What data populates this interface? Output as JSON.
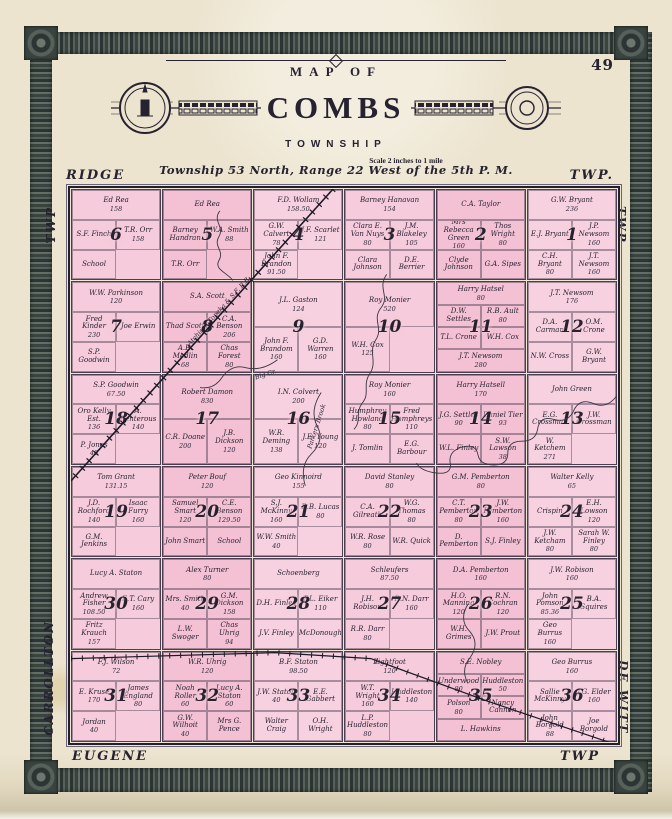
{
  "page": {
    "number": "49"
  },
  "title": {
    "map_of": "MAP OF",
    "name": "COMBS",
    "subtitle": "TOWNSHIP",
    "scale": "Scale 2 inches to 1 mile",
    "legal": "Township 53 North, Range 22 West of the 5th P. M."
  },
  "edges": {
    "top_left": "RIDGE",
    "top_right": "TWP.",
    "left_upper": "TWP",
    "left_lower": "CARROLLTON",
    "right_upper": "TWP",
    "right_lower": "DE WITT",
    "bottom_left": "EUGENE",
    "bottom_right": "TWP"
  },
  "features": {
    "railroad_1": "Atchison Topeka & S.F. R.R.",
    "creek_big": "Big Cr.",
    "creek_parkers": "Parkers Brook"
  },
  "colors": {
    "paper": "#ece4cf",
    "parcel_pink": "#f5c8d8",
    "ink": "#262230",
    "border_band": "#46514c"
  },
  "map": {
    "rows": [
      [
        {
          "number": 6,
          "parcels": [
            {
              "name": "Ed Rea",
              "acres": "158"
            },
            {
              "name": "S.F. Finch"
            },
            {
              "name": "T.R. Orr",
              "acres": "158"
            },
            {
              "name": "School"
            }
          ]
        },
        {
          "number": 5,
          "parcels": [
            {
              "name": "Ed Rea"
            },
            {
              "name": "Barney Handran"
            },
            {
              "name": "W.A. Smith",
              "acres": "88"
            },
            {
              "name": "T.R. Orr"
            }
          ]
        },
        {
          "number": 4,
          "parcels": [
            {
              "name": "F.D. Wollam",
              "acres": "158.50"
            },
            {
              "name": "G.W. Calvert",
              "acres": "78"
            },
            {
              "name": "J.F. Scarlet",
              "acres": "121"
            },
            {
              "name": "John F. Brandon",
              "acres": "91.50"
            }
          ]
        },
        {
          "number": 3,
          "parcels": [
            {
              "name": "Barney Hanavan",
              "acres": "154"
            },
            {
              "name": "Clara E. Van Nuys",
              "acres": "80"
            },
            {
              "name": "J.M. Blakeley",
              "acres": "105"
            },
            {
              "name": "Clara Johnson"
            },
            {
              "name": "D.E. Berrier"
            }
          ]
        },
        {
          "number": 2,
          "parcels": [
            {
              "name": "C.A. Taylor"
            },
            {
              "name": "Mrs Rebecca Green",
              "acres": "160"
            },
            {
              "name": "Thos Wright",
              "acres": "80"
            },
            {
              "name": "Clyde Johnson"
            },
            {
              "name": "G.A. Sipes"
            }
          ]
        },
        {
          "number": 1,
          "parcels": [
            {
              "name": "G.W. Bryant",
              "acres": "236"
            },
            {
              "name": "E.J. Bryant"
            },
            {
              "name": "J.P. Newsom",
              "acres": "160"
            },
            {
              "name": "C.H. Bryant",
              "acres": "80"
            },
            {
              "name": "J.T. Newsom",
              "acres": "160"
            }
          ]
        }
      ],
      [
        {
          "number": 7,
          "parcels": [
            {
              "name": "W.W. Parkinson",
              "acres": "120"
            },
            {
              "name": "Fred Kinder",
              "acres": "230"
            },
            {
              "name": "Joe Erwin"
            },
            {
              "name": "S.P. Goodwin"
            }
          ]
        },
        {
          "number": 8,
          "parcels": [
            {
              "name": "S.A. Scott"
            },
            {
              "name": "Thad Scott"
            },
            {
              "name": "C.A. Benson",
              "acres": "206"
            },
            {
              "name": "A.B. Medlin",
              "acres": "68"
            },
            {
              "name": "Chas Forest",
              "acres": "80"
            }
          ]
        },
        {
          "number": 9,
          "parcels": [
            {
              "name": "J.L. Gaston",
              "acres": "124"
            },
            {
              "name": "John F. Brandom",
              "acres": "160"
            },
            {
              "name": "G.D. Warren",
              "acres": "160"
            }
          ]
        },
        {
          "number": 10,
          "parcels": [
            {
              "name": "Roy Monier",
              "acres": "520"
            },
            {
              "name": "W.H. Cox",
              "acres": "125"
            }
          ]
        },
        {
          "number": 11,
          "parcels": [
            {
              "name": "Harry Hatsel",
              "acres": "80"
            },
            {
              "name": "D.W. Settles"
            },
            {
              "name": "R.B. Ault",
              "acres": "80"
            },
            {
              "name": "T.L. Crone"
            },
            {
              "name": "W.H. Cox"
            },
            {
              "name": "J.T. Newsom",
              "acres": "280"
            }
          ]
        },
        {
          "number": 12,
          "parcels": [
            {
              "name": "J.T. Newsom",
              "acres": "176"
            },
            {
              "name": "D.A. Carman"
            },
            {
              "name": "O.M. Crone"
            },
            {
              "name": "N.W. Cross"
            },
            {
              "name": "G.W. Bryant"
            }
          ]
        }
      ],
      [
        {
          "number": 18,
          "parcels": [
            {
              "name": "S.P. Goodwin",
              "acres": "67.50"
            },
            {
              "name": "Oro Kelly Est.",
              "acres": "136"
            },
            {
              "name": "A. Renterous",
              "acres": "140"
            },
            {
              "name": "P. Jones",
              "acres": "40"
            }
          ]
        },
        {
          "number": 17,
          "parcels": [
            {
              "name": "Robert Damon",
              "acres": "830"
            },
            {
              "name": "C.R. Doane",
              "acres": "200"
            },
            {
              "name": "J.B. Dickson",
              "acres": "120"
            }
          ]
        },
        {
          "number": 16,
          "parcels": [
            {
              "name": "I.N. Colvert",
              "acres": "200"
            },
            {
              "name": "W.R. Deming",
              "acres": "138"
            },
            {
              "name": "J.E. Young",
              "acres": "120"
            }
          ]
        },
        {
          "number": 15,
          "parcels": [
            {
              "name": "Roy Monier",
              "acres": "160"
            },
            {
              "name": "Humphrey Howland",
              "acres": "80"
            },
            {
              "name": "Fred Humphreys",
              "acres": "110"
            },
            {
              "name": "J. Tomlin"
            },
            {
              "name": "E.G. Barbour"
            }
          ]
        },
        {
          "number": 14,
          "parcels": [
            {
              "name": "Harry Hatsell",
              "acres": "170"
            },
            {
              "name": "J.G. Settles",
              "acres": "90"
            },
            {
              "name": "Daniel Tier",
              "acres": "93"
            },
            {
              "name": "W.L. Finley"
            },
            {
              "name": "S.W. Lawson",
              "acres": "38"
            }
          ]
        },
        {
          "number": 13,
          "parcels": [
            {
              "name": "John Green"
            },
            {
              "name": "E.G. Crossman"
            },
            {
              "name": "J.W. Crossman"
            },
            {
              "name": "W. Ketchem",
              "acres": "271"
            }
          ]
        }
      ],
      [
        {
          "number": 19,
          "parcels": [
            {
              "name": "Tom Grant",
              "acres": "131.15"
            },
            {
              "name": "J.D. Rochford",
              "acres": "140"
            },
            {
              "name": "Isaac Furry",
              "acres": "160"
            },
            {
              "name": "G.M. Jenkins"
            }
          ]
        },
        {
          "number": 20,
          "parcels": [
            {
              "name": "Peter Bouf",
              "acres": "120"
            },
            {
              "name": "Samuel Smart",
              "acres": "120"
            },
            {
              "name": "C.E. Benson",
              "acres": "129.50"
            },
            {
              "name": "John Smart"
            },
            {
              "name": "School"
            }
          ]
        },
        {
          "number": 21,
          "parcels": [
            {
              "name": "Geo Kinnoird",
              "acres": "155"
            },
            {
              "name": "S.J. McKinny",
              "acres": "160"
            },
            {
              "name": "B.B. Lucas",
              "acres": "80"
            },
            {
              "name": "W.W. Smith",
              "acres": "40"
            }
          ]
        },
        {
          "number": 22,
          "parcels": [
            {
              "name": "David Stanley",
              "acres": "80"
            },
            {
              "name": "C.A. Gilreath"
            },
            {
              "name": "W.G. Thomas",
              "acres": "80"
            },
            {
              "name": "W.R. Rose",
              "acres": "80"
            },
            {
              "name": "W.R. Quick"
            }
          ]
        },
        {
          "number": 23,
          "parcels": [
            {
              "name": "G.M. Pemberton",
              "acres": "80"
            },
            {
              "name": "C.T. Pemberton",
              "acres": "80"
            },
            {
              "name": "J.W. Pemberton",
              "acres": "160"
            },
            {
              "name": "D. Pemberton"
            },
            {
              "name": "S.J. Finley"
            }
          ]
        },
        {
          "number": 24,
          "parcels": [
            {
              "name": "Walter Kelly",
              "acres": "65"
            },
            {
              "name": "Crispin"
            },
            {
              "name": "E.H. Lowson",
              "acres": "120"
            },
            {
              "name": "J.W. Ketcham",
              "acres": "80"
            },
            {
              "name": "Sarah W. Finley",
              "acres": "80"
            }
          ]
        }
      ],
      [
        {
          "number": 30,
          "parcels": [
            {
              "name": "Lucy A. Staton"
            },
            {
              "name": "Andrew Fisher",
              "acres": "108.50"
            },
            {
              "name": "E.T. Cary",
              "acres": "160"
            },
            {
              "name": "Fritz Krauch",
              "acres": "157"
            }
          ]
        },
        {
          "number": 29,
          "parcels": [
            {
              "name": "Alex Turner",
              "acres": "80"
            },
            {
              "name": "Mrs. Smith",
              "acres": "40"
            },
            {
              "name": "G.M. Dickson",
              "acres": "158"
            },
            {
              "name": "L.W. Swoger"
            },
            {
              "name": "Chas Uhrig",
              "acres": "94"
            }
          ]
        },
        {
          "number": 28,
          "parcels": [
            {
              "name": "Schoenberg"
            },
            {
              "name": "D.H. Finley"
            },
            {
              "name": "P.L. Eiker",
              "acres": "110"
            },
            {
              "name": "J.V. Finley"
            },
            {
              "name": "McDonough"
            }
          ]
        },
        {
          "number": 27,
          "parcels": [
            {
              "name": "Schleufers",
              "acres": "87.50"
            },
            {
              "name": "J.H. Robison"
            },
            {
              "name": "R.N. Darr",
              "acres": "160"
            },
            {
              "name": "R.R. Darr",
              "acres": "80"
            }
          ]
        },
        {
          "number": 26,
          "parcels": [
            {
              "name": "D.A. Pemberton",
              "acres": "160"
            },
            {
              "name": "H.O. Manning",
              "acres": "120"
            },
            {
              "name": "R.N. Cochran",
              "acres": "120"
            },
            {
              "name": "W.H. Grimes"
            },
            {
              "name": "J.W. Prout"
            }
          ]
        },
        {
          "number": 25,
          "parcels": [
            {
              "name": "J.W. Robison",
              "acres": "160"
            },
            {
              "name": "John Pomson",
              "acres": "85.36"
            },
            {
              "name": "B.A. Squires"
            },
            {
              "name": "Geo Burrus",
              "acres": "160"
            }
          ]
        }
      ],
      [
        {
          "number": 31,
          "parcels": [
            {
              "name": "F.J. Wilson",
              "acres": "72"
            },
            {
              "name": "E. Kruse",
              "acres": "170"
            },
            {
              "name": "James England",
              "acres": "80"
            },
            {
              "name": "Jordan",
              "acres": "40"
            }
          ]
        },
        {
          "number": 32,
          "parcels": [
            {
              "name": "W.R. Uhrig",
              "acres": "120"
            },
            {
              "name": "Noah Roller",
              "acres": "60"
            },
            {
              "name": "Lucy A. Staton",
              "acres": "60"
            },
            {
              "name": "G.W. Wilhoit",
              "acres": "40"
            },
            {
              "name": "Mrs G. Pence"
            }
          ]
        },
        {
          "number": 33,
          "parcels": [
            {
              "name": "B.F. Staton",
              "acres": "98.50"
            },
            {
              "name": "J.W. Staton",
              "acres": "40"
            },
            {
              "name": "E.E. Gabbert"
            },
            {
              "name": "Walter Craig"
            },
            {
              "name": "O.H. Wright"
            }
          ]
        },
        {
          "number": 34,
          "parcels": [
            {
              "name": "Lightfoot",
              "acres": "120"
            },
            {
              "name": "W.T. Wright",
              "acres": "160"
            },
            {
              "name": "Huddleston",
              "acres": "140"
            },
            {
              "name": "L.P. Huddleston",
              "acres": "80"
            }
          ]
        },
        {
          "number": 35,
          "parcels": [
            {
              "name": "S.E. Nobley"
            },
            {
              "name": "Underwood",
              "acres": "80"
            },
            {
              "name": "Huddleston",
              "acres": "50"
            },
            {
              "name": "Polson",
              "acres": "80"
            },
            {
              "name": "Nancy Cannon"
            },
            {
              "name": "L. Hawkins"
            }
          ]
        },
        {
          "number": 36,
          "parcels": [
            {
              "name": "Geo Burrus",
              "acres": "160"
            },
            {
              "name": "Sallie McKinny"
            },
            {
              "name": "J.G. Elder",
              "acres": "160"
            },
            {
              "name": "John Borgold",
              "acres": "88"
            },
            {
              "name": "Joe Borgold"
            }
          ]
        }
      ]
    ]
  }
}
